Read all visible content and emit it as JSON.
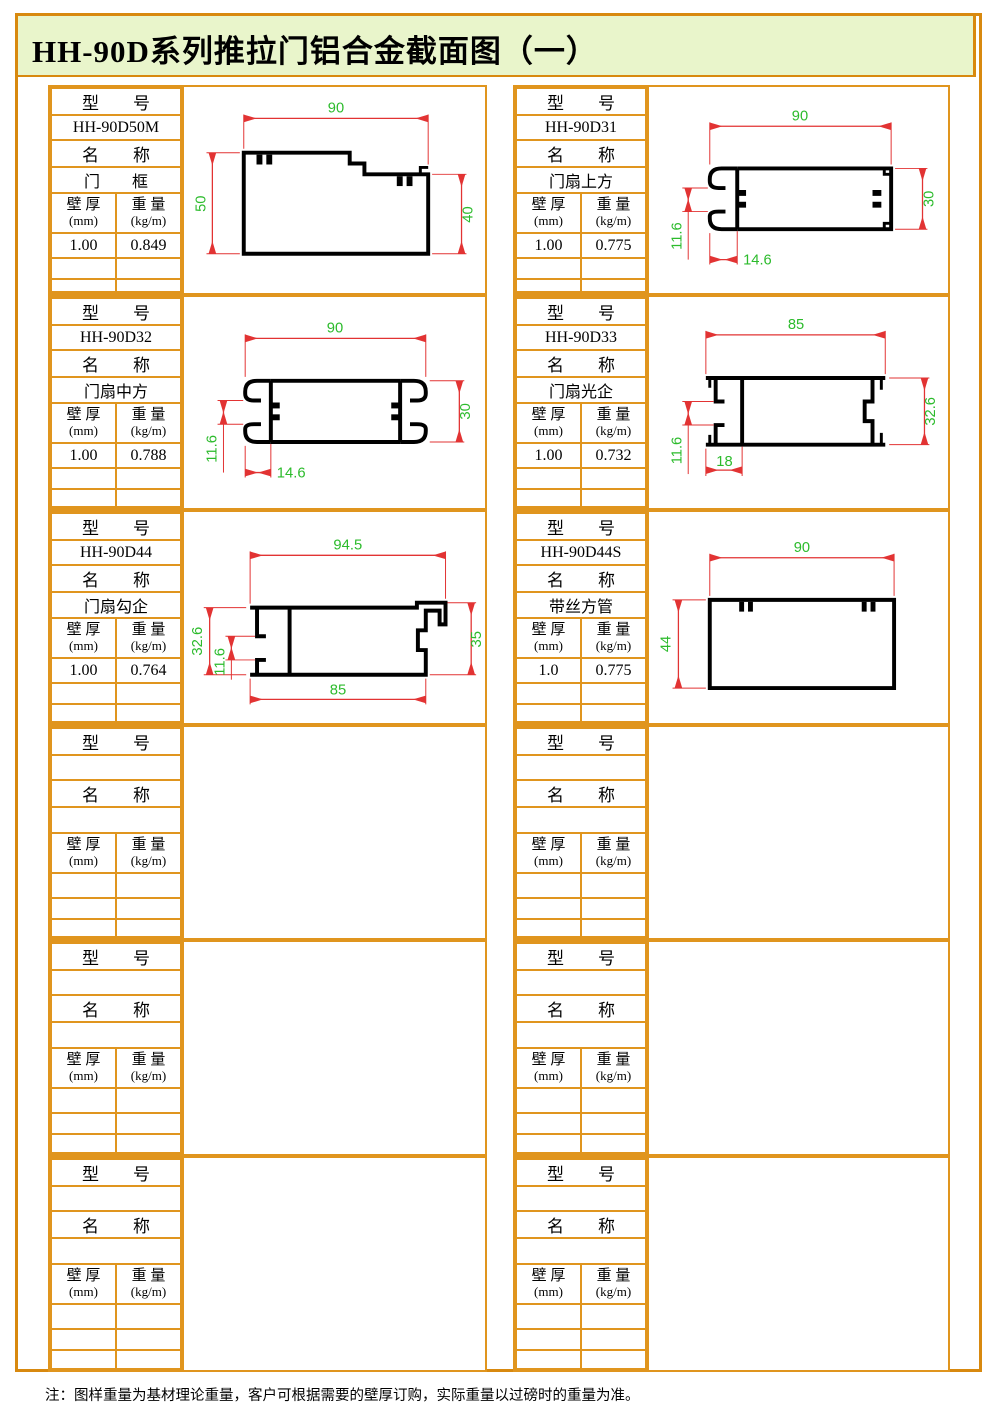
{
  "title": "HH-90D系列推拉门铝合金截面图（一）",
  "footer_note": "注：图样重量为基材理论重量，客户可根据需要的壁厚订购，实际重量以过磅时的重量为准。",
  "labels": {
    "model": "型　　号",
    "name": "名　　称",
    "thickness_l1": "壁 厚",
    "thickness_l2": "(mm)",
    "weight_l1": "重 量",
    "weight_l2": "(kg/m)"
  },
  "colors": {
    "grid_border": "#E0951E",
    "outer_border": "#D8890F",
    "title_bg": "#E9F5CB",
    "dimension_line": "#E23333",
    "dimension_text": "#2CBB2C",
    "profile_line": "#000000"
  },
  "cells": [
    {
      "model": "HH-90D50M",
      "name": "门　　框",
      "thickness": "1.00",
      "weight": "0.849",
      "dims": {
        "top": "90",
        "left": "50",
        "right": "40"
      }
    },
    {
      "model": "HH-90D31",
      "name": "门扇上方",
      "thickness": "1.00",
      "weight": "0.775",
      "dims": {
        "top": "90",
        "right": "30",
        "left": "11.6",
        "bottom": "14.6"
      }
    },
    {
      "model": "HH-90D32",
      "name": "门扇中方",
      "thickness": "1.00",
      "weight": "0.788",
      "dims": {
        "top": "90",
        "right": "30",
        "left": "11.6",
        "bottom": "14.6"
      }
    },
    {
      "model": "HH-90D33",
      "name": "门扇光企",
      "thickness": "1.00",
      "weight": "0.732",
      "dims": {
        "top": "85",
        "right": "32.6",
        "left": "11.6",
        "bottom": "18"
      }
    },
    {
      "model": "HH-90D44",
      "name": "门扇勾企",
      "thickness": "1.00",
      "weight": "0.764",
      "dims": {
        "top": "94.5",
        "right": "35",
        "left": "32.6",
        "inner": "11.6",
        "bottom": "85"
      }
    },
    {
      "model": "HH-90D44S",
      "name": "带丝方管",
      "thickness": "1.0",
      "weight": "0.775",
      "dims": {
        "top": "90",
        "left": "44"
      }
    },
    {
      "model": "",
      "name": "",
      "thickness": "",
      "weight": ""
    },
    {
      "model": "",
      "name": "",
      "thickness": "",
      "weight": ""
    },
    {
      "model": "",
      "name": "",
      "thickness": "",
      "weight": ""
    },
    {
      "model": "",
      "name": "",
      "thickness": "",
      "weight": ""
    },
    {
      "model": "",
      "name": "",
      "thickness": "",
      "weight": ""
    },
    {
      "model": "",
      "name": "",
      "thickness": "",
      "weight": ""
    }
  ]
}
